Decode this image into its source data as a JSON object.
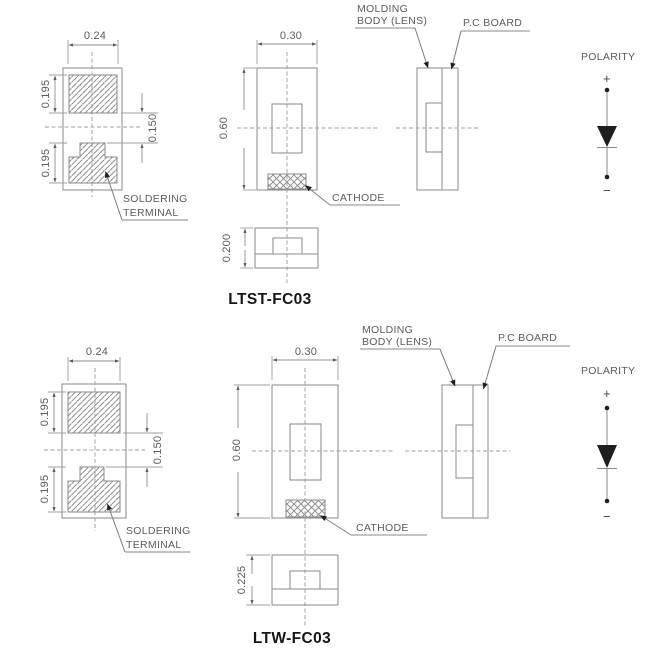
{
  "colors": {
    "drawing_line": "#8a8a8a",
    "dimension_line": "#9c9c9c",
    "text": "#5c5c5c",
    "title_text": "#161616",
    "arrowhead": "#1f1f1f",
    "background": "#ffffff"
  },
  "sections": {
    "top": {
      "title": "LTST-FC03",
      "dims": {
        "pad_width": "0.24",
        "pad_top_height": "0.195",
        "pad_gap": "0.150",
        "pad_bottom_height": "0.195",
        "body_width": "0.30",
        "body_height": "0.60",
        "profile_height": "0.200"
      },
      "labels": {
        "soldering1": "SOLDERING",
        "soldering2": "TERMINAL",
        "cathode": "CATHODE",
        "molding1": "MOLDING",
        "molding2": "BODY (LENS)",
        "pcboard": "P.C BOARD",
        "polarity": "POLARITY",
        "plus": "+",
        "minus": "−"
      }
    },
    "bottom": {
      "title": "LTW-FC03",
      "dims": {
        "pad_width": "0.24",
        "pad_top_height": "0.195",
        "pad_gap": "0.150",
        "pad_bottom_height": "0.195",
        "body_width": "0.30",
        "body_height": "0.60",
        "profile_height": "0.225"
      },
      "labels": {
        "soldering1": "SOLDERING",
        "soldering2": "TERMINAL",
        "cathode": "CATHODE",
        "molding1": "MOLDING",
        "molding2": "BODY (LENS)",
        "pcboard": "P.C BOARD",
        "polarity": "POLARITY",
        "plus": "+",
        "minus": "−"
      }
    }
  }
}
